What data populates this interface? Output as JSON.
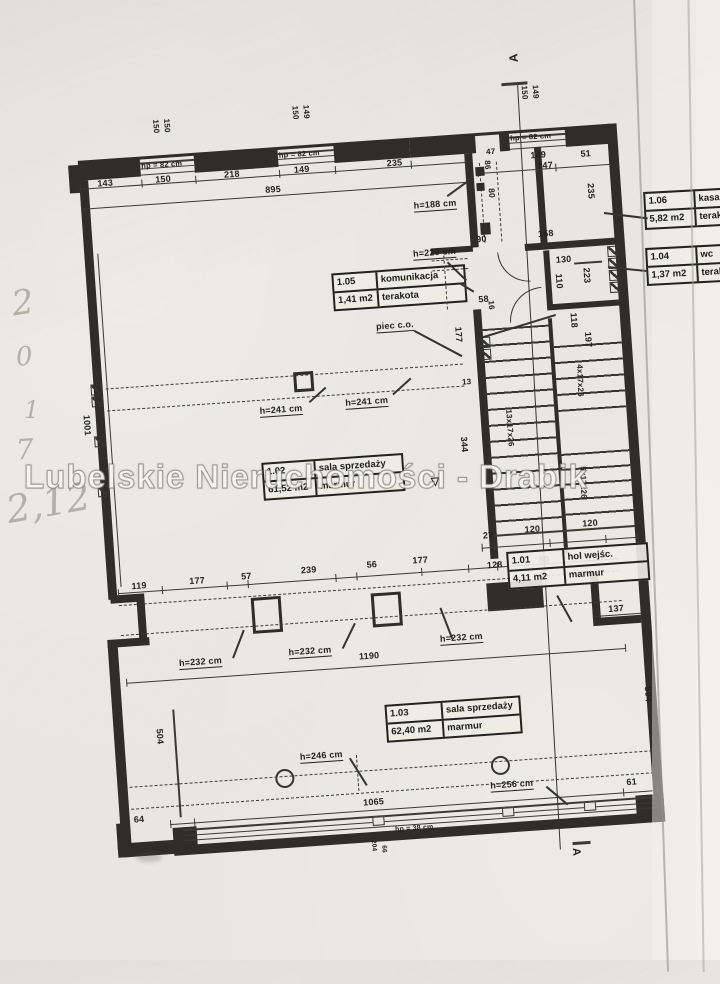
{
  "watermark": {
    "text": "Lubelskie Nieruchomości - Drabik"
  },
  "section_marker": "A",
  "rooms": [
    {
      "id": "1.05",
      "name": "komunikacja",
      "area": "1,41 m2",
      "floor": "terakota"
    },
    {
      "id": "1.06",
      "name": "kasa",
      "area": "5,82 m2",
      "floor": "terakota"
    },
    {
      "id": "1.04",
      "name": "wc",
      "area": "1,37 m2",
      "floor": "terakota"
    },
    {
      "id": "1.02",
      "name": "sala sprzedaży",
      "area": "61,52 m2",
      "floor": "marmur"
    },
    {
      "id": "1.01",
      "name": "hol wejśc.",
      "area": "4,11 m2",
      "floor": "marmur"
    },
    {
      "id": "1.03",
      "name": "sala sprzedaży",
      "area": "62,40 m2",
      "floor": "marmur"
    }
  ],
  "handwriting": {
    "marks": [
      {
        "t": "2",
        "x": 12,
        "y": 286,
        "fs": 34,
        "r": -8
      },
      {
        "t": "0",
        "x": 16,
        "y": 344,
        "fs": 26,
        "r": -5
      },
      {
        "t": "1",
        "x": 24,
        "y": 398,
        "fs": 24,
        "r": 0
      },
      {
        "t": "7",
        "x": 16,
        "y": 436,
        "fs": 28,
        "r": -4
      },
      {
        "t": "2,12",
        "x": 6,
        "y": 484,
        "fs": 38,
        "r": -10
      }
    ]
  },
  "plan": {
    "walls": [
      [
        90,
        146,
        14,
        28
      ],
      [
        100,
        142,
        534,
        3
      ],
      [
        100,
        144,
        62,
        18
      ],
      [
        216,
        144,
        84,
        18
      ],
      [
        356,
        144,
        76,
        18
      ],
      [
        432,
        144,
        66,
        18
      ],
      [
        522,
        144,
        10,
        18
      ],
      [
        588,
        144,
        46,
        18
      ],
      [
        100,
        162,
        9,
        420
      ],
      [
        102,
        578,
        34,
        8
      ],
      [
        128,
        584,
        8,
        44
      ],
      [
        96,
        622,
        42,
        8
      ],
      [
        96,
        628,
        10,
        212
      ],
      [
        92,
        806,
        12,
        26
      ],
      [
        92,
        826,
        58,
        14
      ],
      [
        148,
        832,
        492,
        10
      ],
      [
        148,
        814,
        24,
        20
      ],
      [
        612,
        814,
        28,
        20
      ],
      [
        630,
        142,
        10,
        700
      ],
      [
        582,
        634,
        48,
        8
      ],
      [
        582,
        588,
        8,
        48
      ],
      [
        486,
        162,
        8,
        94
      ],
      [
        484,
        318,
        8,
        250
      ],
      [
        556,
        160,
        7,
        98
      ],
      [
        540,
        256,
        92,
        7
      ],
      [
        446,
        254,
        42,
        6
      ],
      [
        558,
        264,
        6,
        58
      ],
      [
        558,
        318,
        74,
        6
      ],
      [
        558,
        332,
        4,
        236
      ],
      [
        478,
        592,
        56,
        28
      ]
    ],
    "boxes": [
      [
        242,
        590,
        30,
        36
      ],
      [
        362,
        594,
        30,
        34
      ],
      [
        300,
        368,
        20,
        20
      ]
    ],
    "lines": [
      [
        100,
        170,
        386,
        1
      ],
      [
        100,
        190,
        386,
        1
      ],
      [
        498,
        182,
        134,
        1
      ],
      [
        476,
        556,
        158,
        1
      ],
      [
        110,
        576,
        502,
        1
      ],
      [
        112,
        666,
        500,
        1
      ],
      [
        146,
        810,
        488,
        1
      ],
      [
        582,
        632,
        50,
        1
      ],
      [
        156,
        696,
        1.5,
        108
      ],
      [
        113,
        236,
        1,
        334
      ],
      [
        162,
        148,
        54,
        2
      ],
      [
        162,
        154,
        54,
        1.2
      ],
      [
        162,
        160,
        54,
        1.2
      ],
      [
        300,
        148,
        56,
        2
      ],
      [
        300,
        154,
        56,
        1.2
      ],
      [
        300,
        160,
        56,
        1.2
      ],
      [
        532,
        148,
        56,
        2
      ],
      [
        532,
        154,
        56,
        1.2
      ],
      [
        532,
        160,
        56,
        1.2
      ],
      [
        158,
        816,
        474,
        2
      ],
      [
        158,
        822,
        474,
        1.2
      ],
      [
        158,
        827,
        474,
        1.2
      ],
      [
        528,
        94,
        26,
        2.5
      ],
      [
        546,
        856,
        18,
        2.5
      ],
      [
        588,
        278,
        28,
        1.5
      ],
      [
        489,
        544,
        141,
        2
      ]
    ],
    "ticks": [
      [
        100,
        165
      ],
      [
        162,
        165
      ],
      [
        216,
        165
      ],
      [
        300,
        165
      ],
      [
        356,
        165
      ],
      [
        432,
        165
      ],
      [
        486,
        165
      ],
      [
        100,
        186
      ],
      [
        486,
        186
      ],
      [
        498,
        178
      ],
      [
        556,
        178
      ],
      [
        576,
        178
      ],
      [
        630,
        178
      ],
      [
        476,
        552
      ],
      [
        488,
        552
      ],
      [
        544,
        552
      ],
      [
        600,
        552
      ],
      [
        632,
        552
      ],
      [
        110,
        572
      ],
      [
        154,
        572
      ],
      [
        219,
        572
      ],
      [
        240,
        572
      ],
      [
        328,
        572
      ],
      [
        349,
        572
      ],
      [
        414,
        572
      ],
      [
        461,
        572
      ],
      [
        490,
        572
      ],
      [
        112,
        662
      ],
      [
        612,
        662
      ],
      [
        146,
        806
      ],
      [
        170,
        806
      ],
      [
        600,
        806
      ],
      [
        634,
        806
      ]
    ],
    "rlines": [
      [
        466,
        202,
        30,
        -32,
        1.5
      ],
      [
        462,
        268,
        26,
        48,
        1.5
      ],
      [
        424,
        334,
        54,
        32,
        1.5
      ],
      [
        314,
        398,
        22,
        -38,
        1.5
      ],
      [
        398,
        396,
        24,
        -38,
        1.5
      ],
      [
        220,
        648,
        30,
        -65,
        1.5
      ],
      [
        330,
        646,
        28,
        -60,
        1.5
      ],
      [
        440,
        644,
        33,
        -107,
        1.5
      ],
      [
        330,
        756,
        32,
        62,
        1.5
      ],
      [
        524,
        798,
        28,
        44,
        1.5
      ],
      [
        548,
        608,
        30,
        65,
        1.8
      ],
      [
        488,
        346,
        80,
        -13,
        1.5
      ],
      [
        473,
        290,
        16,
        35,
        1.5
      ],
      [
        544,
        96,
        766,
        90.8,
        1.2
      ]
    ],
    "dashh": [
      [
        112,
        371,
        358
      ],
      [
        112,
        393,
        358
      ],
      [
        110,
        588,
        502
      ],
      [
        110,
        618,
        502
      ],
      [
        108,
        770,
        524
      ],
      [
        108,
        792,
        524
      ],
      [
        446,
        266,
        36
      ],
      [
        446,
        276,
        36
      ]
    ],
    "dashv": [
      [
        500,
        172,
        80
      ],
      [
        517,
        172,
        80
      ],
      [
        458,
        262,
        54
      ],
      [
        336,
        754,
        36
      ]
    ],
    "hatch": [
      [
        622,
        264
      ],
      [
        622,
        276
      ],
      [
        622,
        288
      ],
      [
        622,
        300
      ],
      [
        488,
        346
      ],
      [
        488,
        358
      ],
      [
        97,
        366
      ],
      [
        97,
        378
      ],
      [
        97,
        418
      ],
      [
        97,
        468
      ]
    ],
    "solids": [
      [
        496,
        176,
        9,
        9
      ],
      [
        496,
        192,
        8,
        8
      ],
      [
        497,
        232,
        10,
        12
      ]
    ],
    "mulls": [
      [
        348,
        817,
        10,
        7
      ],
      [
        478,
        817,
        10,
        7
      ],
      [
        560,
        817,
        10,
        7
      ]
    ],
    "circles": [
      [
        254,
        763,
        15
      ],
      [
        470,
        765,
        15
      ]
    ],
    "arcs": [
      [
        512,
        262,
        30,
        "bl"
      ],
      [
        520,
        300,
        32,
        "tl"
      ]
    ],
    "stairs": [
      [
        489,
        338,
        70,
        206,
        16
      ],
      [
        562,
        360,
        68,
        66,
        16
      ],
      [
        562,
        468,
        68,
        74,
        15
      ]
    ],
    "dims": [
      {
        "t": "143",
        "x": 118,
        "y": 162
      },
      {
        "t": "150",
        "x": 176,
        "y": 162
      },
      {
        "t": "218",
        "x": 245,
        "y": 162
      },
      {
        "t": "149",
        "x": 315,
        "y": 162
      },
      {
        "t": "235",
        "x": 408,
        "y": 162
      },
      {
        "t": "895",
        "x": 285,
        "y": 180
      },
      {
        "t": "hp = 82 cm",
        "x": 163,
        "y": 148,
        "f": 7.5
      },
      {
        "t": "hp = 82 cm",
        "x": 301,
        "y": 147,
        "f": 7.5
      },
      {
        "t": "hp = 82 cm",
        "x": 533,
        "y": 146,
        "f": 7.5
      },
      {
        "t": "150",
        "x": 184,
        "y": 106,
        "r": 90,
        "f": 8
      },
      {
        "t": "150",
        "x": 195,
        "y": 106,
        "r": 90,
        "f": 8
      },
      {
        "t": "150",
        "x": 324,
        "y": 102,
        "r": 90,
        "f": 8
      },
      {
        "t": "149",
        "x": 335,
        "y": 102,
        "r": 90,
        "f": 8
      },
      {
        "t": "150",
        "x": 554,
        "y": 98,
        "r": 90,
        "f": 8
      },
      {
        "t": "149",
        "x": 565,
        "y": 98,
        "r": 90,
        "f": 8
      },
      {
        "t": "A",
        "x": 536,
        "y": 74,
        "r": -90,
        "f": 12,
        "n": "section-marker-letter"
      },
      {
        "t": "A",
        "x": 554,
        "y": 862,
        "r": 90,
        "f": 11,
        "n": "section-marker-letter"
      },
      {
        "t": "47",
        "x": 508,
        "y": 158,
        "f": 8
      },
      {
        "t": "86",
        "x": 512,
        "y": 170,
        "r": 90,
        "f": 8
      },
      {
        "t": "80",
        "x": 515,
        "y": 198,
        "r": 90,
        "f": 8.5
      },
      {
        "t": "h=188 cm",
        "x": 432,
        "y": 206,
        "u": 1
      },
      {
        "t": "149",
        "x": 552,
        "y": 164
      },
      {
        "t": "51",
        "x": 602,
        "y": 166
      },
      {
        "t": "247",
        "x": 558,
        "y": 175
      },
      {
        "t": "235",
        "x": 614,
        "y": 200,
        "r": 90
      },
      {
        "t": "90",
        "x": 492,
        "y": 244
      },
      {
        "t": "158",
        "x": 554,
        "y": 243
      },
      {
        "t": "130",
        "x": 570,
        "y": 270
      },
      {
        "t": "110",
        "x": 576,
        "y": 288,
        "r": 90
      },
      {
        "t": "223",
        "x": 604,
        "y": 284,
        "r": 90
      },
      {
        "t": "58",
        "x": 490,
        "y": 304
      },
      {
        "t": "16",
        "x": 506,
        "y": 310,
        "r": 90,
        "f": 8
      },
      {
        "t": "h=220 cm",
        "x": 428,
        "y": 254,
        "u": 1
      },
      {
        "t": "piec c.o.",
        "x": 386,
        "y": 324,
        "u": 1
      },
      {
        "t": "177",
        "x": 472,
        "y": 334,
        "r": 90
      },
      {
        "t": "13",
        "x": 468,
        "y": 386,
        "f": 8
      },
      {
        "t": "118",
        "x": 588,
        "y": 328,
        "r": 90
      },
      {
        "t": "197",
        "x": 601,
        "y": 348,
        "r": 90
      },
      {
        "t": "4x17x26",
        "x": 590,
        "y": 380,
        "r": 92,
        "f": 8
      },
      {
        "t": "13x17x26",
        "x": 516,
        "y": 420,
        "r": 90,
        "f": 8
      },
      {
        "t": "5x17x26",
        "x": 586,
        "y": 482,
        "r": 92,
        "f": 8
      },
      {
        "t": "344",
        "x": 470,
        "y": 444,
        "r": 90
      },
      {
        "t": "h=241 cm",
        "x": 264,
        "y": 400,
        "u": 1
      },
      {
        "t": "h=241 cm",
        "x": 350,
        "y": 398,
        "u": 1
      },
      {
        "t": "1001",
        "x": 95,
        "y": 396,
        "r": 90
      },
      {
        "t": "27",
        "x": 478,
        "y": 540
      },
      {
        "t": "120",
        "x": 520,
        "y": 537
      },
      {
        "t": "120",
        "x": 578,
        "y": 535
      },
      {
        "t": "128",
        "x": 480,
        "y": 570
      },
      {
        "t": "80",
        "x": 532,
        "y": 568
      },
      {
        "t": "119",
        "x": 124,
        "y": 566
      },
      {
        "t": "177",
        "x": 182,
        "y": 565
      },
      {
        "t": "57",
        "x": 234,
        "y": 564
      },
      {
        "t": "239",
        "x": 294,
        "y": 562
      },
      {
        "t": "56",
        "x": 360,
        "y": 561
      },
      {
        "t": "177",
        "x": 406,
        "y": 560
      },
      {
        "t": "h=232 cm",
        "x": 166,
        "y": 646,
        "u": 1
      },
      {
        "t": "h=232 cm",
        "x": 276,
        "y": 643,
        "u": 1
      },
      {
        "t": "h=232 cm",
        "x": 428,
        "y": 640,
        "u": 1
      },
      {
        "t": "1190",
        "x": 346,
        "y": 652
      },
      {
        "t": "137",
        "x": 598,
        "y": 622
      },
      {
        "t": "504",
        "x": 146,
        "y": 714,
        "r": 90
      },
      {
        "t": "504",
        "x": 636,
        "y": 706,
        "r": 90
      },
      {
        "t": "h=246 cm",
        "x": 280,
        "y": 748,
        "u": 1
      },
      {
        "t": "h=256 cm",
        "x": 468,
        "y": 790,
        "u": 1
      },
      {
        "t": "64",
        "x": 110,
        "y": 799
      },
      {
        "t": "1065",
        "x": 340,
        "y": 798
      },
      {
        "t": "61",
        "x": 604,
        "y": 796
      },
      {
        "t": "hp = 38 cm",
        "x": 370,
        "y": 828,
        "f": 7
      },
      {
        "t": "204",
        "x": 350,
        "y": 840,
        "r": 90,
        "f": 6.5
      },
      {
        "t": "66",
        "x": 360,
        "y": 846,
        "r": 90,
        "f": 6.5
      },
      {
        "t": "▽",
        "x": 430,
        "y": 482,
        "f": 11
      }
    ]
  },
  "page": {
    "leaders": [
      [
        604,
        212,
        44,
        7
      ],
      [
        608,
        266,
        40,
        6
      ]
    ]
  }
}
